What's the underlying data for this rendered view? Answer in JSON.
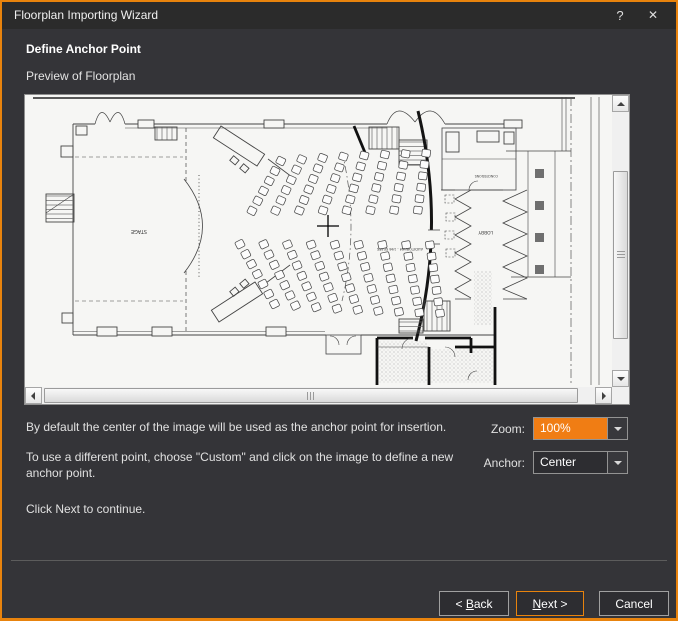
{
  "window": {
    "title": "Floorplan Importing Wizard",
    "help_glyph": "?",
    "close_glyph": "✕"
  },
  "content": {
    "heading": "Define Anchor Point",
    "preview_label": "Preview of Floorplan",
    "para1": "By default the center of the image will be used as the anchor point for insertion.",
    "para2": "To use a different point, choose \"Custom\" and click on the image to define a new anchor point.",
    "para3": "Click Next to continue."
  },
  "controls": {
    "zoom_label": "Zoom:",
    "zoom_value": "100%",
    "anchor_label": "Anchor:",
    "anchor_value": "Center"
  },
  "footer": {
    "back_prefix": "< ",
    "back_mnemonic": "B",
    "back_rest": "ack",
    "next_mnemonic": "N",
    "next_rest": "ext >",
    "cancel": "Cancel"
  },
  "floorplan": {
    "stage_label": "STAGE",
    "lobby_label": "LOBBY",
    "concessions_label": "CONCESSIONS",
    "auditorium_label": "AUDITORIUM - 196 SEATS"
  },
  "colors": {
    "accent_border": "#e8830d",
    "selection_orange": "#f07d14"
  }
}
